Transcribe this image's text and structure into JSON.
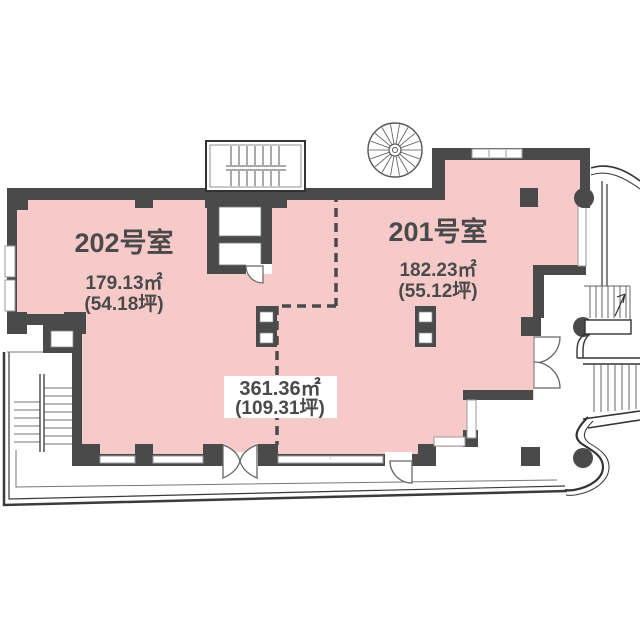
{
  "plan_title": "2F floor plan",
  "colors": {
    "floor_fill": "#F7CACA",
    "wall": "#4A4A4A",
    "text": "#4A4A4A",
    "thin_line": "#555555",
    "background": "#FFFFFF"
  },
  "rooms": {
    "room202": {
      "name": "202号室",
      "area_m2": "179.13㎡",
      "area_tsubo": "(54.18坪)"
    },
    "room201": {
      "name": "201号室",
      "area_m2": "182.23㎡",
      "area_tsubo": "(55.12坪)"
    }
  },
  "total": {
    "area_m2": "361.36㎡",
    "area_tsubo": "(109.31坪)"
  }
}
